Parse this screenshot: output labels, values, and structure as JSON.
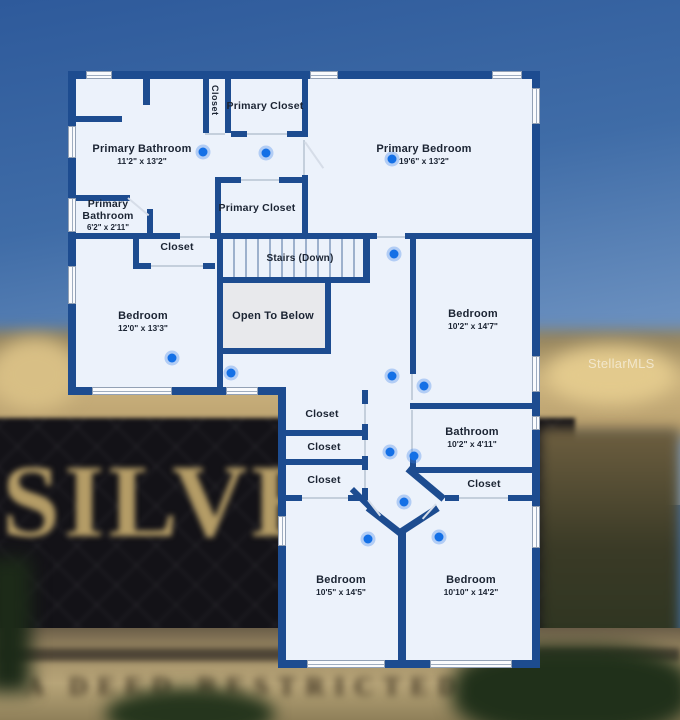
{
  "watermark": "StellarMLS",
  "background_sign": {
    "title": "SILVER",
    "subtext": "A DEED RESTRICTED CO"
  },
  "floorplan": {
    "colors": {
      "wall": "#1d4c90",
      "floor": "#ecf2fb",
      "open_area": "#e8e9ec",
      "camera_dot": "#1470e6",
      "label": "#1b2433"
    },
    "rooms": [
      {
        "name": "Primary Bathroom",
        "dims": "11'2\" x 13'2\""
      },
      {
        "name": "Closet"
      },
      {
        "name": "Primary Closet"
      },
      {
        "name": "Primary Bedroom",
        "dims": "19'6\" x 13'2\""
      },
      {
        "name": "Primary Bathroom",
        "dims": "6'2\" x 2'11\""
      },
      {
        "name": "Primary Closet"
      },
      {
        "name": "Closet"
      },
      {
        "name": "Stairs (Down)"
      },
      {
        "name": "Open To Below"
      },
      {
        "name": "Bedroom",
        "dims": "12'0\" x 13'3\""
      },
      {
        "name": "Bedroom",
        "dims": "10'2\" x 14'7\""
      },
      {
        "name": "Closet"
      },
      {
        "name": "Closet"
      },
      {
        "name": "Closet"
      },
      {
        "name": "Bathroom",
        "dims": "10'2\" x 4'11\""
      },
      {
        "name": "Closet"
      },
      {
        "name": "Bedroom",
        "dims": "10'5\" x 14'5\""
      },
      {
        "name": "Bedroom",
        "dims": "10'10\" x 14'2\""
      }
    ]
  }
}
